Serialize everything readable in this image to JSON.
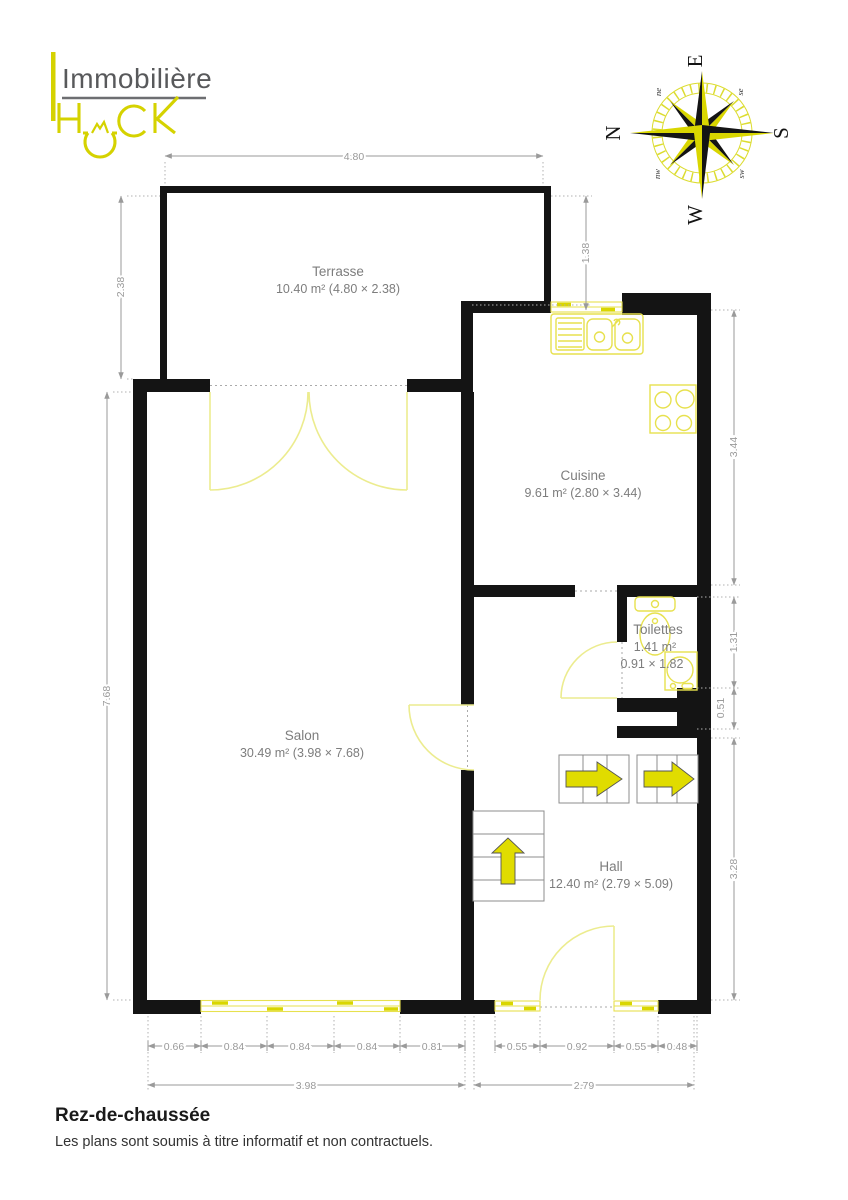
{
  "branding": {
    "agency": "Immobilière",
    "brand": "HACK"
  },
  "compass": {
    "e": "E",
    "n": "N",
    "s": "S",
    "w": "W",
    "ne": "ne",
    "se": "se",
    "sw": "sw",
    "nw": "nw"
  },
  "rooms": {
    "terrasse": {
      "name": "Terrasse",
      "details": "10.40 m² (4.80 × 2.38)"
    },
    "cuisine": {
      "name": "Cuisine",
      "details": "9.61 m² (2.80 × 3.44)"
    },
    "toilettes": {
      "name": "Toilettes",
      "area": "1.41 m²",
      "size": "0.91 × 1.82"
    },
    "salon": {
      "name": "Salon",
      "details": "30.49 m² (3.98 × 7.68)"
    },
    "hall": {
      "name": "Hall",
      "details": "12.40 m² (2.79 × 5.09)"
    }
  },
  "dimensions": {
    "top": "4.80",
    "left_terrace": "2.38",
    "left_salon": "7.68",
    "right_top": "1.38",
    "right_kitchen": "3.44",
    "right_wc": "1.31",
    "right_jog": "0.51",
    "right_hall": "3.28",
    "bottom_left": [
      "0.66",
      "0.84",
      "0.84",
      "0.84",
      "0.81"
    ],
    "bottom_right": [
      "0.55",
      "0.92",
      "0.55",
      "0.48"
    ],
    "total_left": "3.98",
    "total_right": "2.79"
  },
  "footer": {
    "title": "Rez-de-chaussée",
    "disclaimer": "Les plans sont soumis à titre informatif et non contractuels."
  },
  "colors": {
    "brand_yellow": "#d5d200",
    "wall_black": "#141414",
    "dim_gray": "#9a9a9a",
    "fixture_yellow": "#e7e14e"
  }
}
